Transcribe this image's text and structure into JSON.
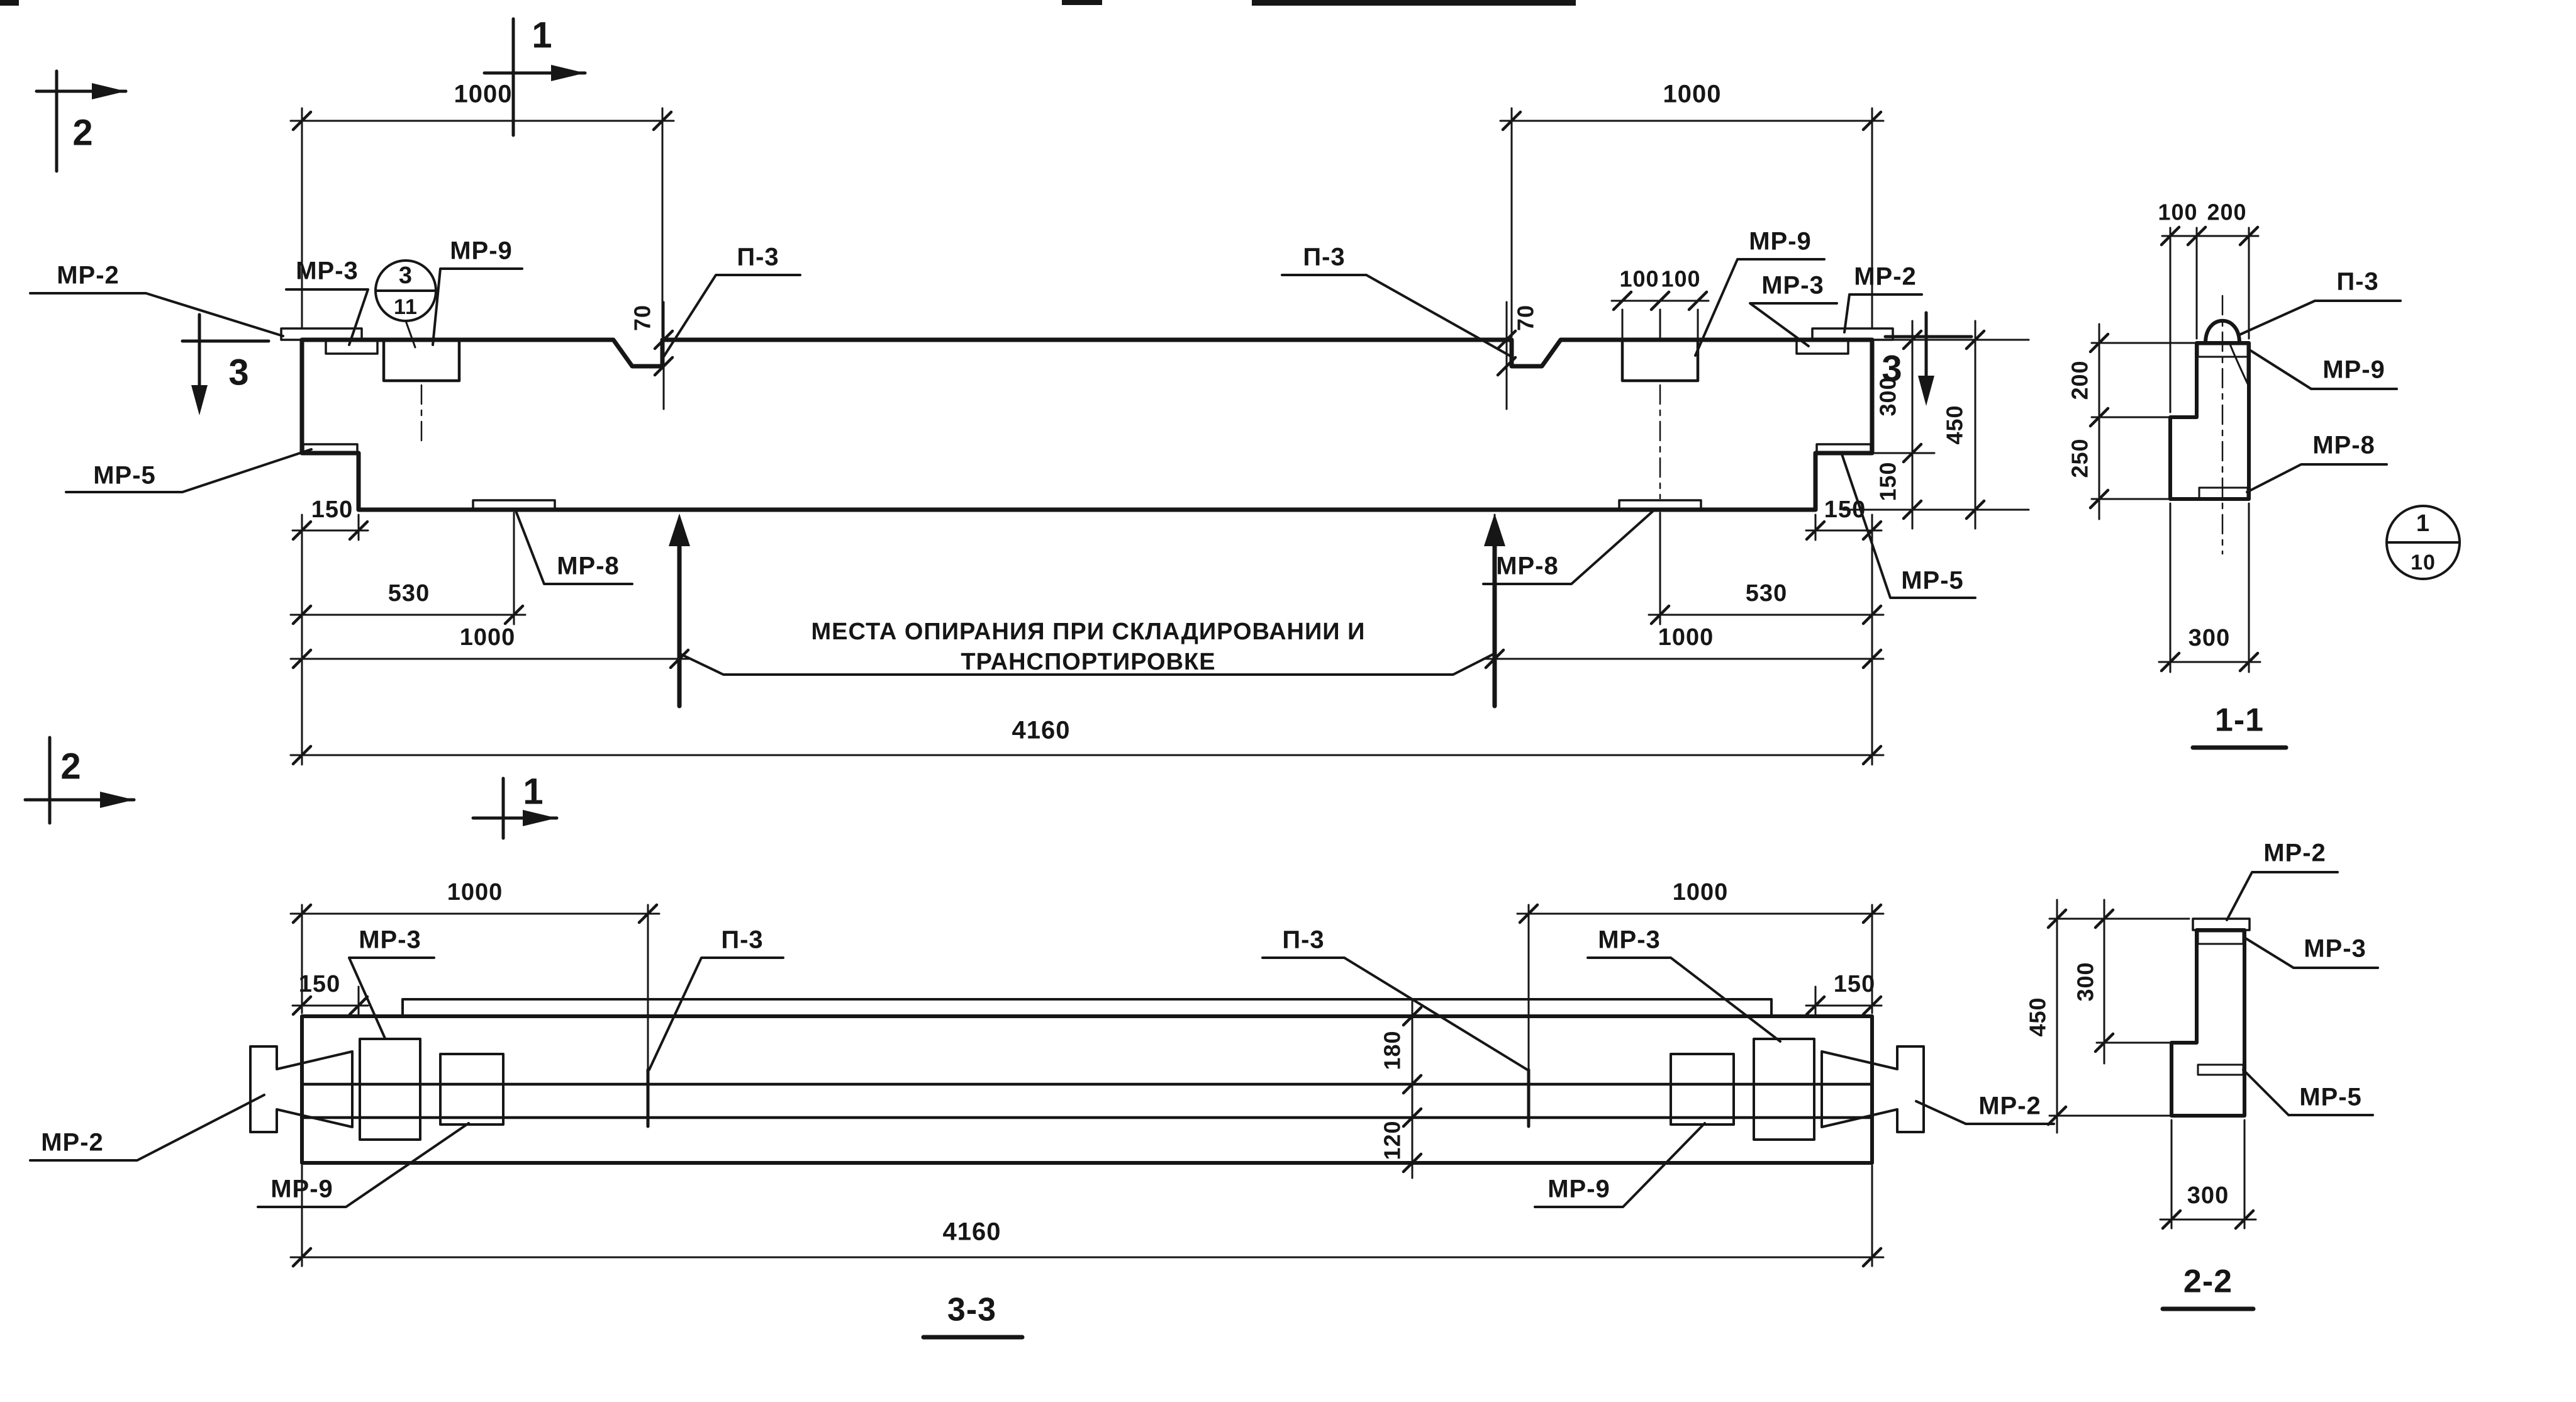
{
  "markers": {
    "m1": "1",
    "m2": "2",
    "m3": "3"
  },
  "labels": {
    "mp2": "МР-2",
    "mp3": "МР-3",
    "mp5": "МР-5",
    "mp8": "МР-8",
    "mp9": "МР-9",
    "p3": "П-3"
  },
  "dims": {
    "d70": "70",
    "d100": "100",
    "d120": "120",
    "d150": "150",
    "d180": "180",
    "d200": "200",
    "d250": "250",
    "d300": "300",
    "d450": "450",
    "d530": "530",
    "d1000": "1000",
    "d4160": "4160"
  },
  "callouts": {
    "detail3": "3",
    "sheet11": "11",
    "detail1": "1",
    "sheet10": "10"
  },
  "notes": {
    "support_line1": "МЕСТА ОПИРАНИЯ ПРИ СКЛАДИРОВАНИИ И",
    "support_line2": "ТРАНСПОРТИРОВКЕ"
  },
  "titles": {
    "s11": "1-1",
    "s22": "2-2",
    "s33": "3-3"
  }
}
